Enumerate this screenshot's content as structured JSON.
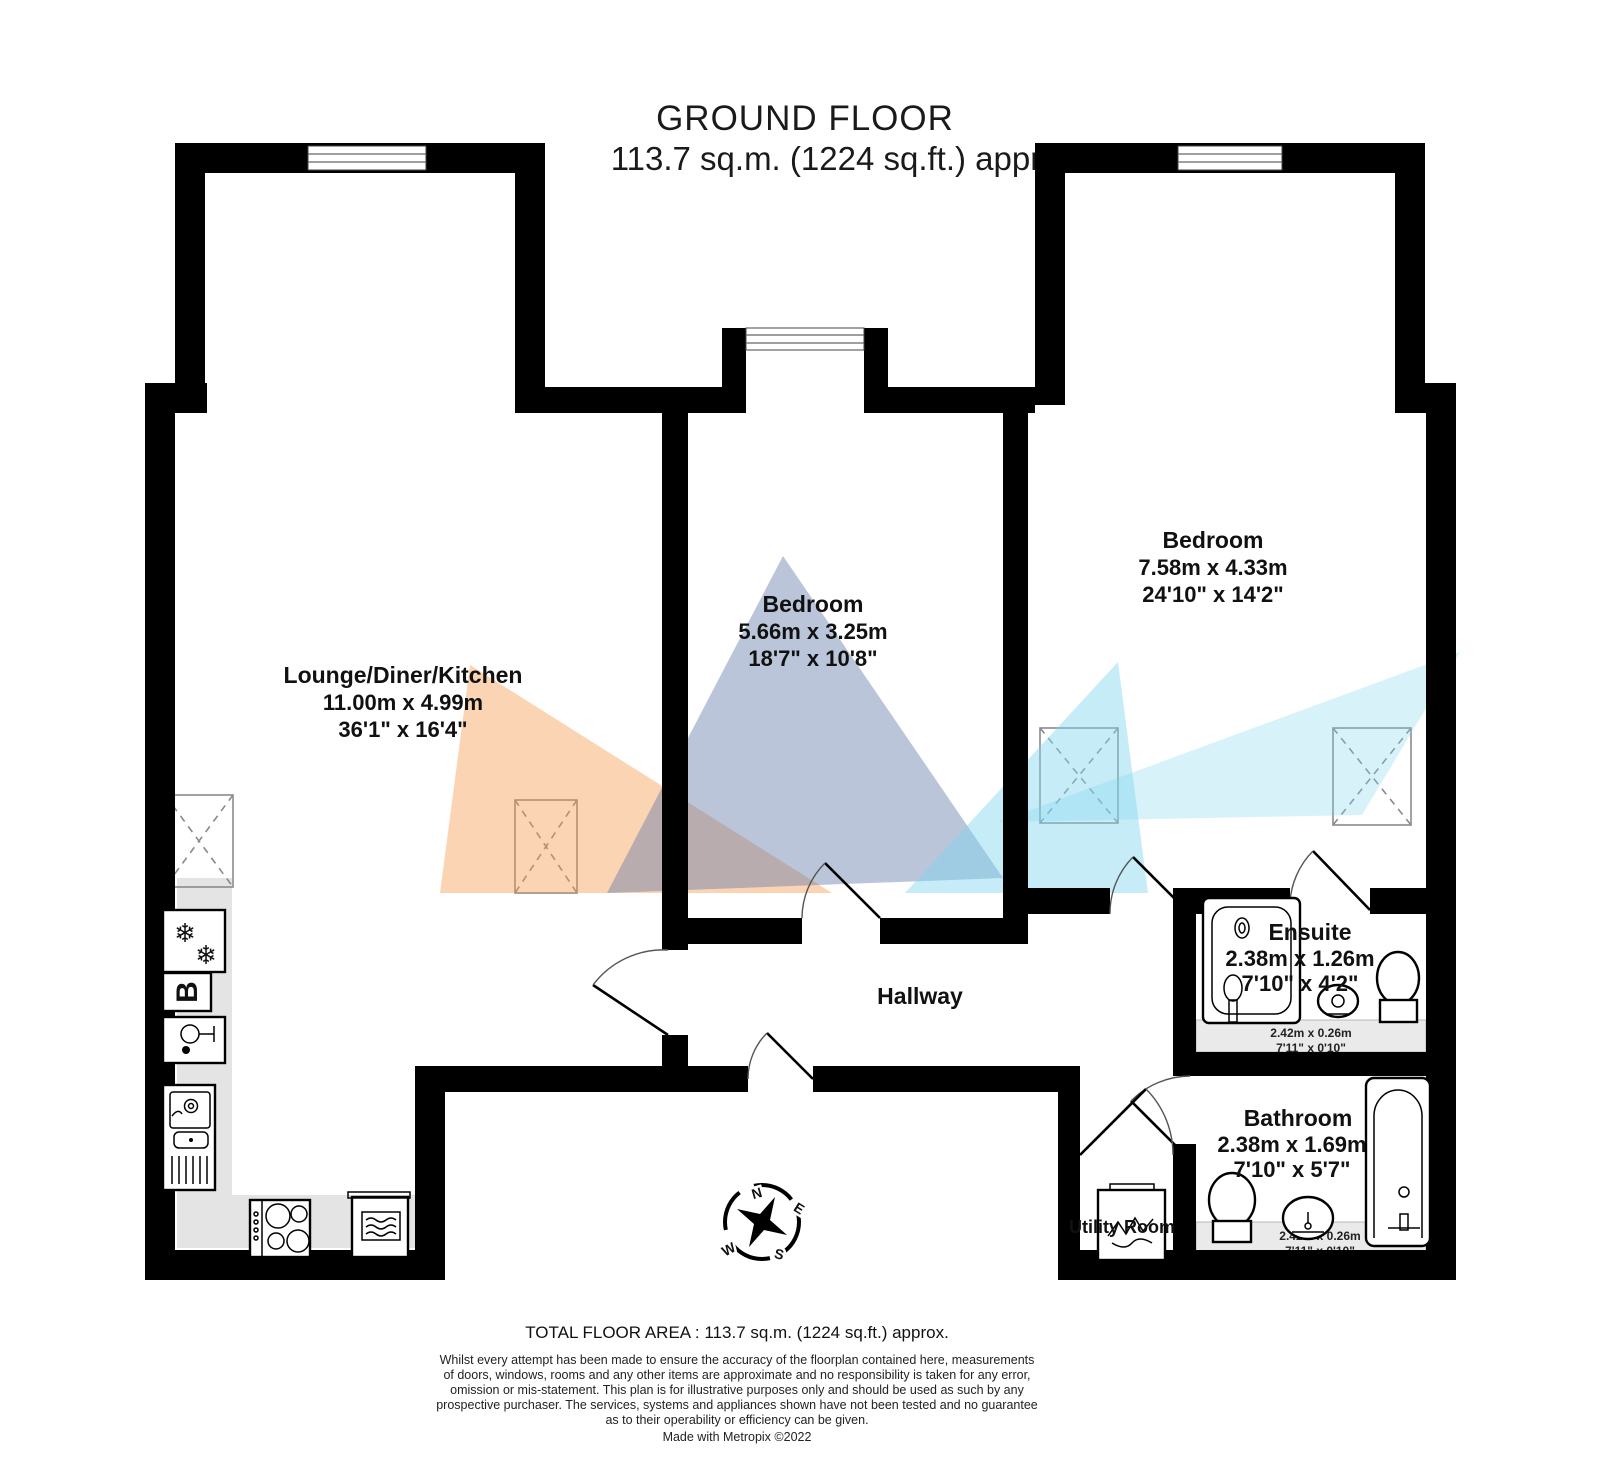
{
  "title": {
    "name": "GROUND FLOOR",
    "area": "113.7 sq.m. (1224 sq.ft.) approx."
  },
  "rooms": {
    "lounge": {
      "name": "Lounge/Diner/Kitchen",
      "metric": "11.00m x 4.99m",
      "imperial": "36'1\" x 16'4\""
    },
    "bedroom_middle": {
      "name": "Bedroom",
      "metric": "5.66m x 3.25m",
      "imperial": "18'7\" x 10'8\""
    },
    "bedroom_right": {
      "name": "Bedroom",
      "metric": "7.58m x 4.33m",
      "imperial": "24'10\" x 14'2\""
    },
    "ensuite": {
      "name": "Ensuite",
      "metric": "2.38m x 1.26m",
      "imperial": "7'10\" x 4'2\"",
      "recess_metric": "2.42m x 0.26m",
      "recess_imperial": "7'11\" x 0'10\""
    },
    "bathroom": {
      "name": "Bathroom",
      "metric": "2.38m x 1.69m",
      "imperial": "7'10\" x 5'7\"",
      "recess_metric": "2.42m x 0.26m",
      "recess_imperial": "7'11\" x 0'10\""
    },
    "hallway": {
      "name": "Hallway"
    },
    "utility": {
      "name": "Utility Room"
    }
  },
  "compass": {
    "north": "N",
    "east": "E",
    "south": "S",
    "west": "W"
  },
  "appliances": {
    "boiler_label": "B"
  },
  "footer": {
    "total_area": "TOTAL FLOOR AREA : 113.7 sq.m. (1224 sq.ft.) approx.",
    "disclaimer_lines": [
      "Whilst every attempt has been made to ensure the accuracy of the floorplan contained here, measurements",
      "of doors, windows, rooms and any other items are approximate and no responsibility is taken for any error,",
      "omission or mis-statement. This plan is for illustrative purposes only and should be used as such by any",
      "prospective purchaser. The services, systems and appliances shown have not been tested and no guarantee",
      "as to their operability or efficiency can be given."
    ],
    "credit": "Made with Metropix ©2022"
  },
  "colors": {
    "wall": "#000000",
    "cone_orange": "#F2994A",
    "cone_slate": "#5C74A8",
    "cone_cyan": "#7FD4EE",
    "counter_fill": "#E4E4E4",
    "recess_fill": "#EAEAEA"
  }
}
